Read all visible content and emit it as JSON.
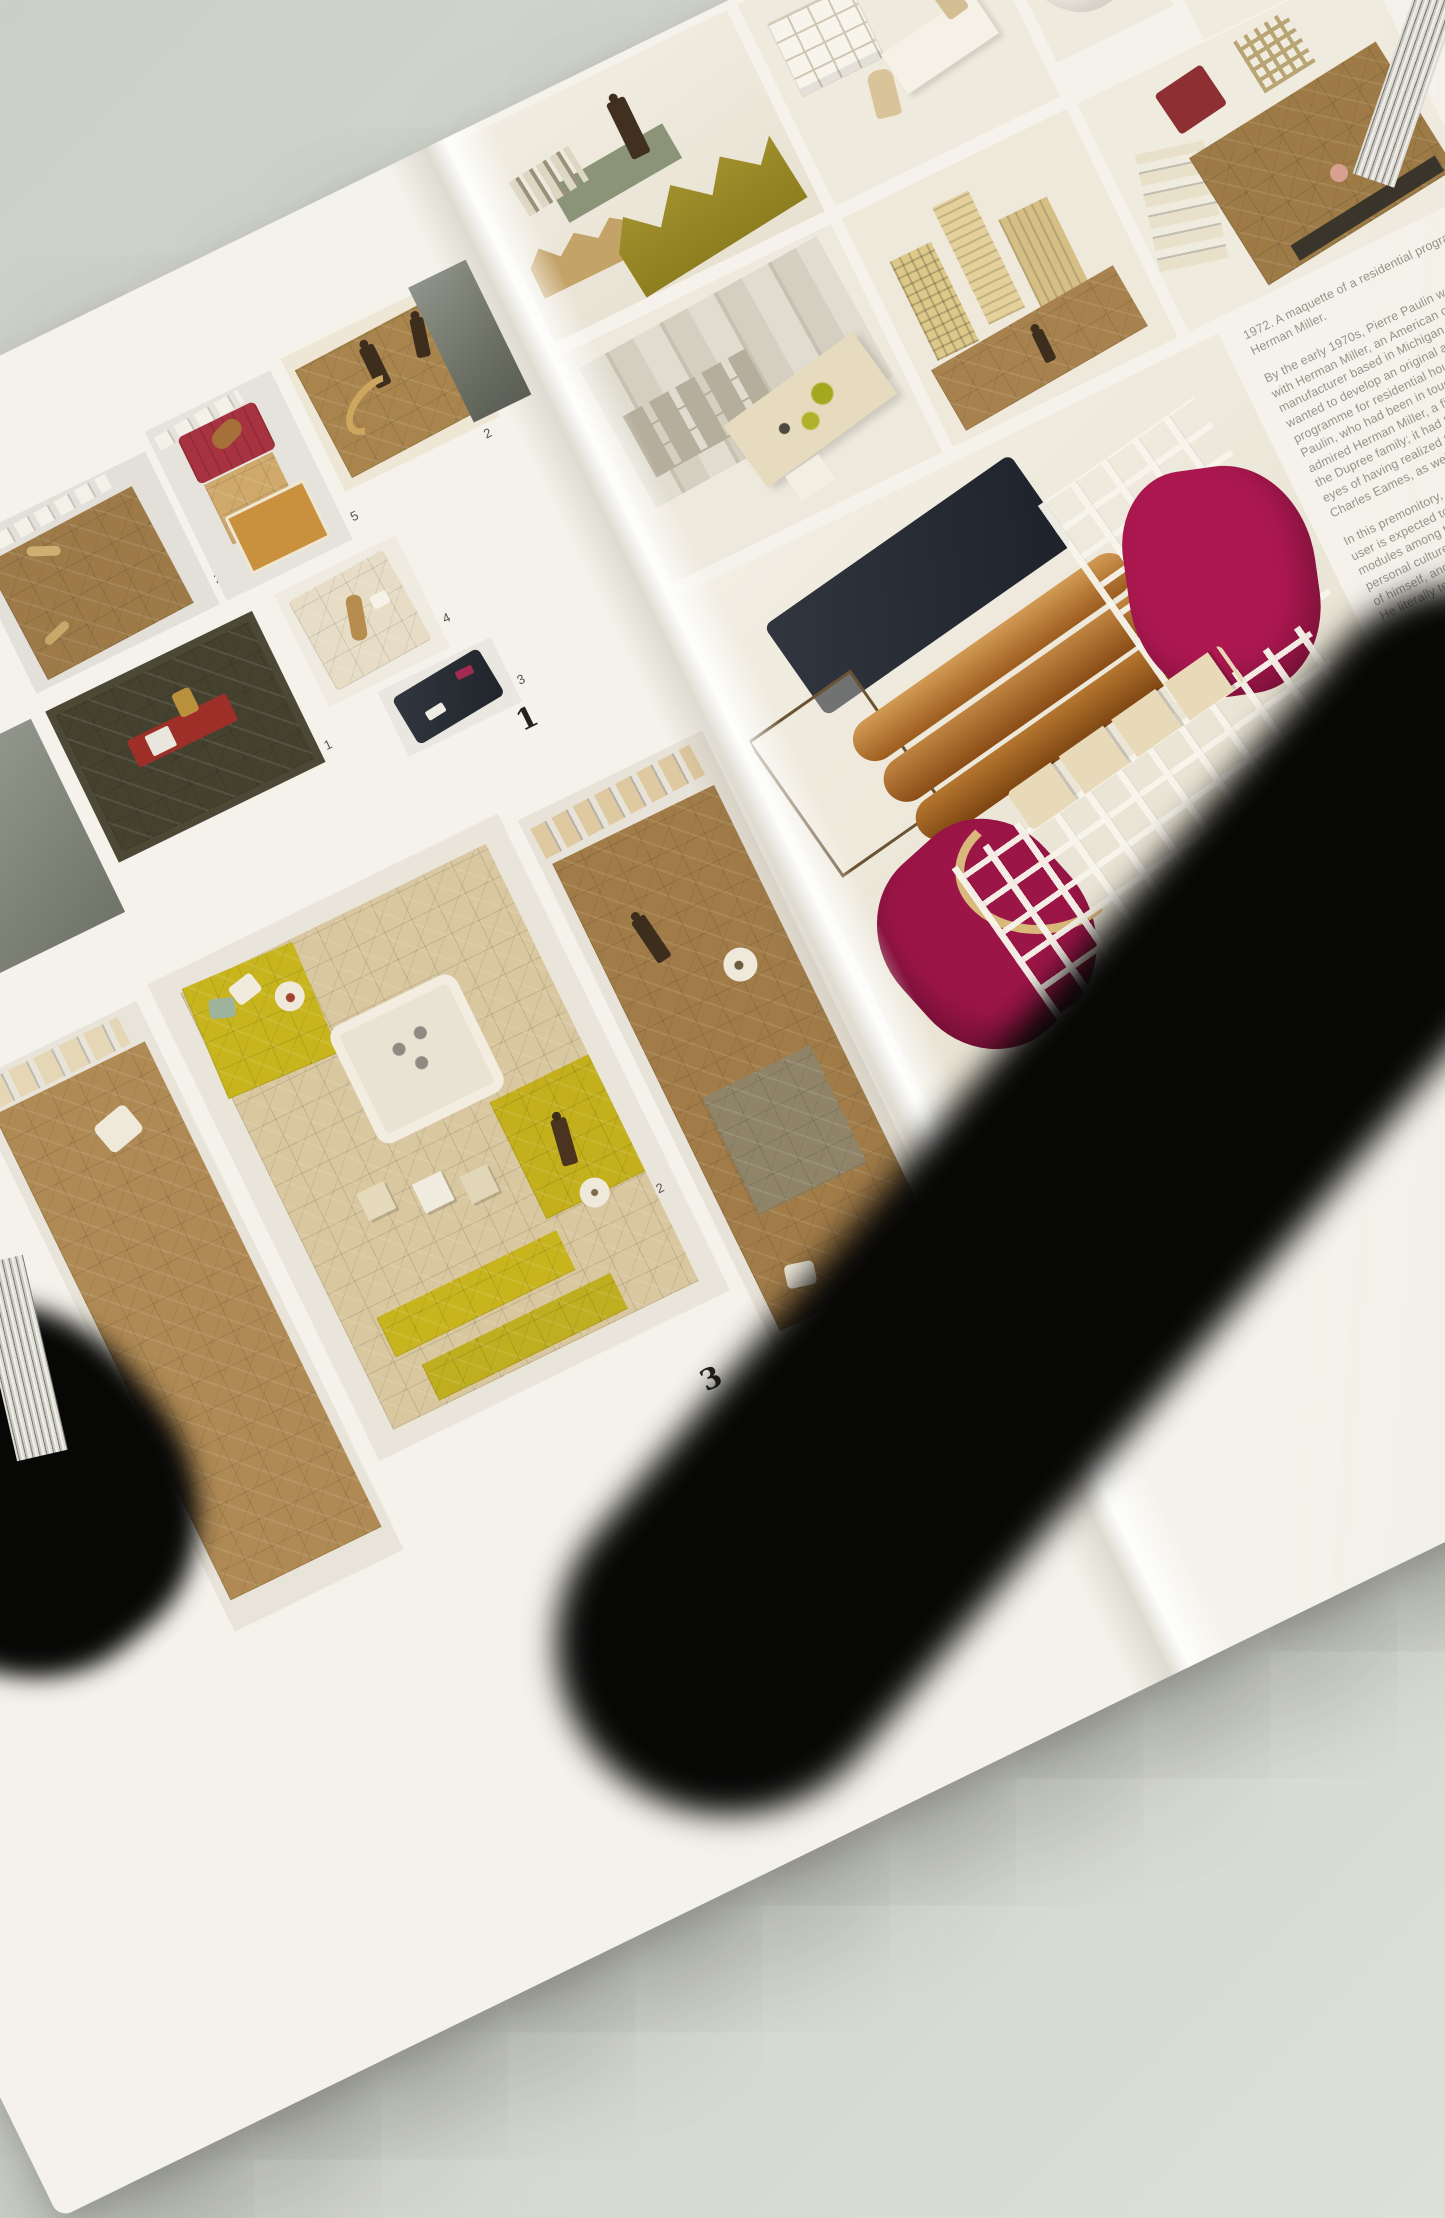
{
  "book": {
    "left_page": {
      "plate_number": "1",
      "page_number": "3",
      "montage_labels": {
        "brown_mat": "2",
        "red_chair": "5",
        "figures_mat": "2",
        "cream_table": "4",
        "navy_sofa": "3",
        "olive_mat": "1"
      },
      "bottom_label": "2"
    },
    "right_page": {
      "caption": {
        "title_lines": [
          "1972. A maquette of a residential programme for",
          "Herman Miller."
        ],
        "para1_lines": [
          "By the early 1970s, Pierre Paulin was working",
          "with Herman Miller, an American office furniture",
          "manufacturer based in Michigan. The company",
          "wanted to develop an original and revolutionary",
          "programme for residential housing. It contacted",
          "Paulin, who had been in touch since 1968 and",
          "admired Herman Miller, a firm founded by",
          "the Dupree family; it had the great merit in the",
          "eyes of having realized the designs of",
          "Charles Eames, as well as those of"
        ],
        "para2_lines": [
          "In this premonitory, overarching concept, the",
          "user is expected to associate the various",
          "modules among themselves according to his",
          "personal culture, the perception he has",
          "of himself, and the lifestyle he leads.",
          "He literally tells his own story."
        ],
        "para3_lines": [
          "Paulin's maquette presents",
          "numerous places to sit in",
          "of a truly vibrant and",
          "layout of the space:",
          "horizontal surfaces",
          "and vertical",
          "elements",
          "conceived"
        ]
      }
    },
    "colors": {
      "background": "#d5d9d0",
      "page": "#f4f2ea",
      "shadow": "#070706",
      "montage_bg": "#e7e4dd",
      "magenta_chair": "#ad1850",
      "chartreuse_mat": "#c8b51e",
      "brown_mat": "#9d7a48",
      "olive_sofa": "#9b8b25",
      "red_chair": "#a83340",
      "navy_sofa": "#262b33",
      "wood": "#c9913e"
    }
  }
}
